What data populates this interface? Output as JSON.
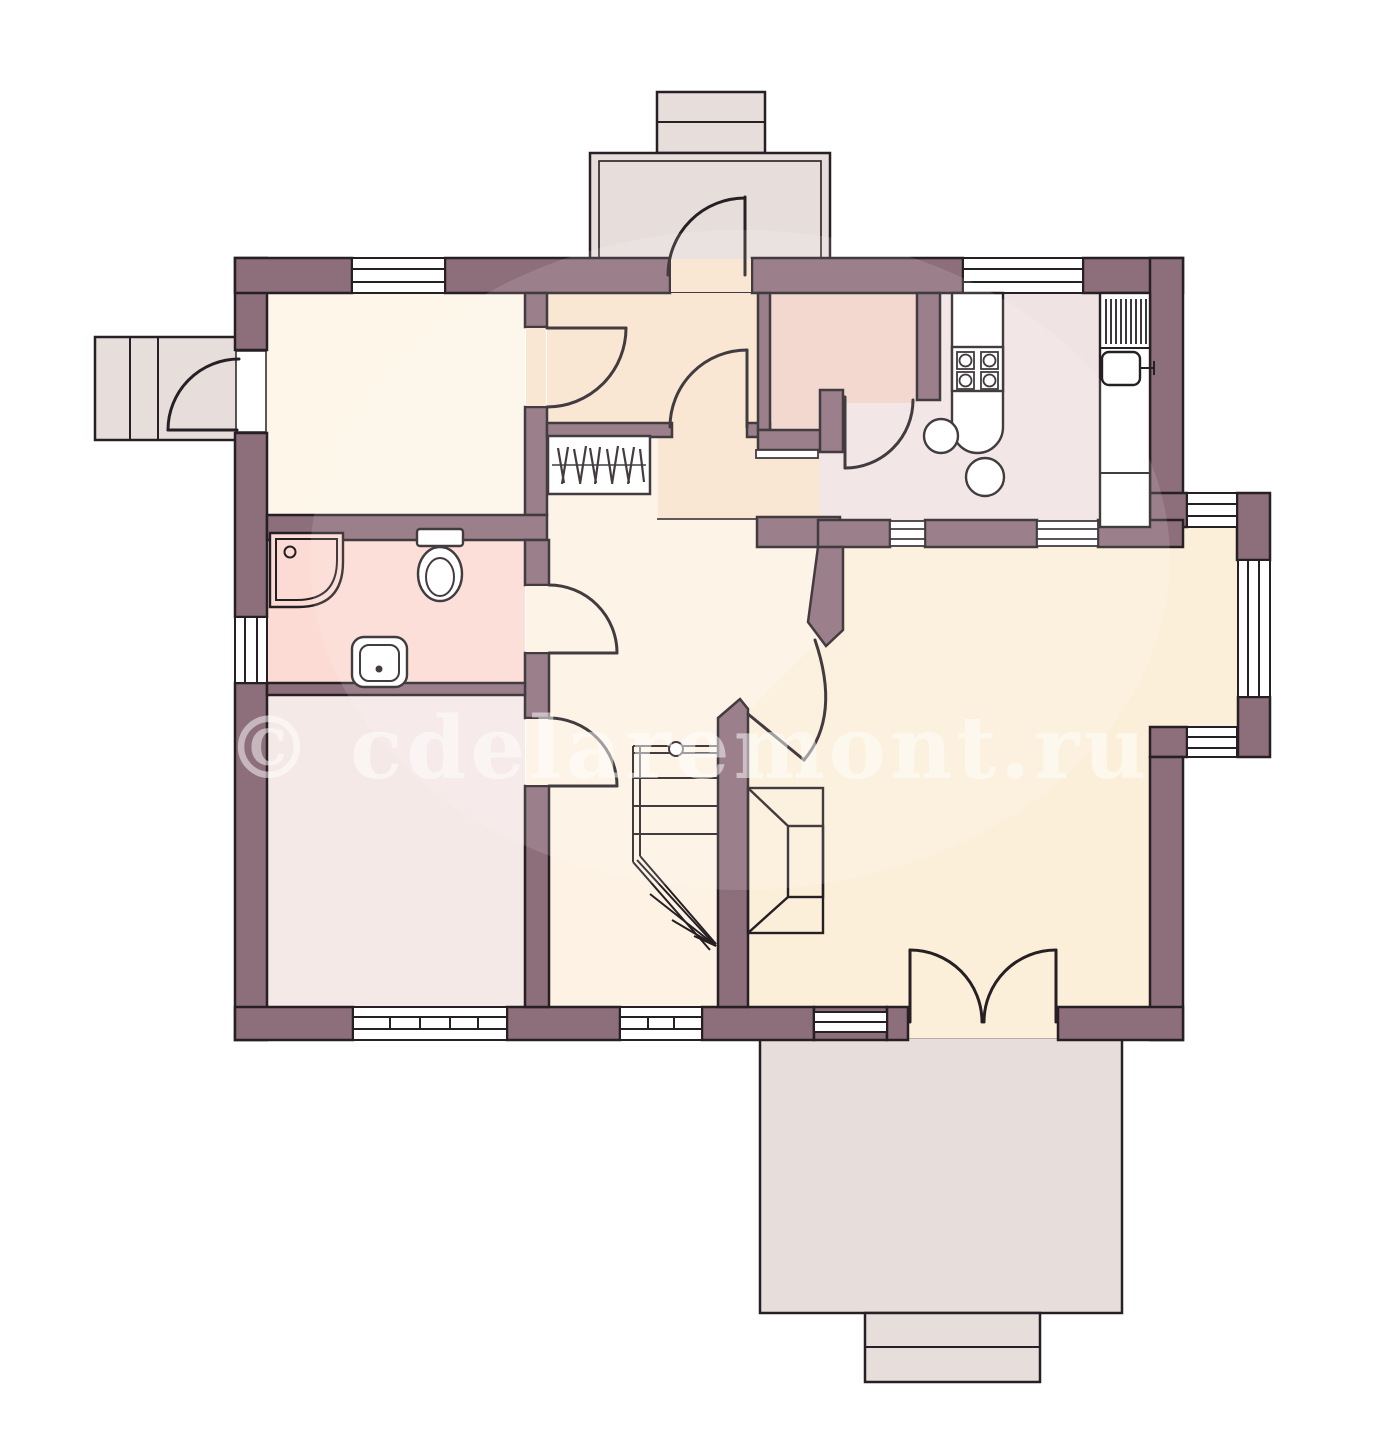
{
  "watermark": {
    "text": "© cdelaremont.ru"
  },
  "palette": {
    "wall": "#8d6e7b",
    "outline": "#261f24",
    "room_top_left": "#fdf6e9",
    "bathroom": "#fbdbd3",
    "room_bottom_left": "#f5e9e7",
    "entrance_hall": "#f8e3cd",
    "hallway": "#fdf2e3",
    "pantry": "#f2d3ca",
    "kitchen": "#f0e3e3",
    "living_room": "#fcefd9",
    "outdoor_grey": "#e7dedc",
    "white": "#ffffff",
    "watermark_color": "#ffffff"
  },
  "regions": [
    {
      "name": "room-top-left"
    },
    {
      "name": "bathroom"
    },
    {
      "name": "room-bottom-left"
    },
    {
      "name": "entrance-hall"
    },
    {
      "name": "hallway"
    },
    {
      "name": "pantry"
    },
    {
      "name": "kitchen"
    },
    {
      "name": "living-room"
    },
    {
      "name": "vestibule"
    },
    {
      "name": "side-porch"
    },
    {
      "name": "terrace"
    }
  ],
  "fixtures": [
    "shower-tray",
    "toilet",
    "washbasin",
    "wardrobe-hangers",
    "kitchen-stove",
    "kitchen-counter",
    "kitchen-round-sinks",
    "sink-drainer",
    "kitchen-sink",
    "stairs",
    "fireplace"
  ],
  "doors": [
    "porch-door",
    "vestibule-door",
    "room-top-left-door",
    "hall-door",
    "kitchen-door",
    "bathroom-door",
    "room-bottom-left-door",
    "living-room-diagonal-door",
    "french-door-terrace"
  ],
  "windows": [
    "window-top-left",
    "window-kitchen-top",
    "window-bathroom-left",
    "bay-window-top",
    "bay-window-right",
    "bay-window-bottom",
    "window-bottom-left",
    "window-bottom-hall",
    "window-bottom-living"
  ]
}
